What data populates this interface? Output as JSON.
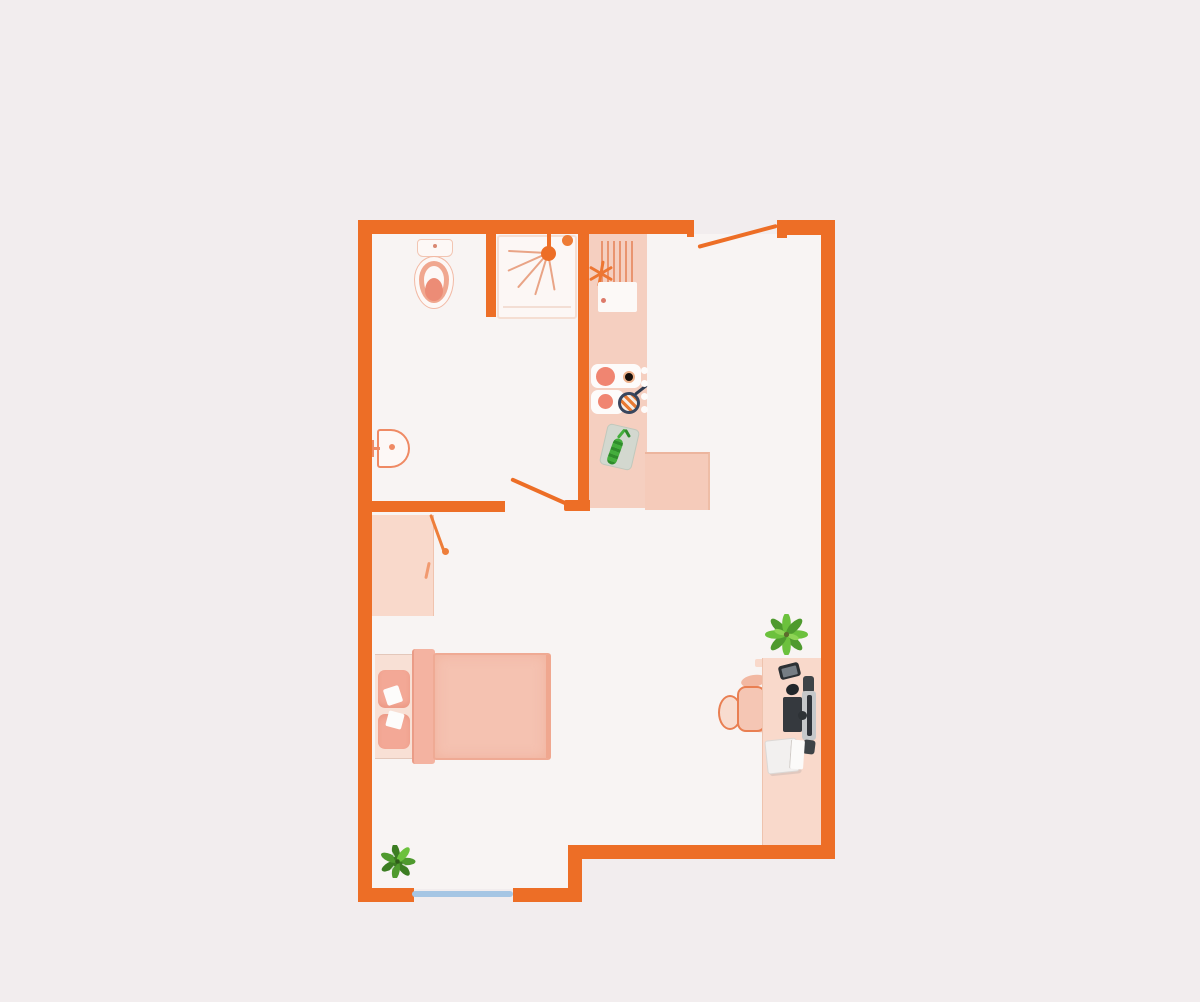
{
  "scene": {
    "type": "floor-plan",
    "style": "top-down studio apartment illustration, no text labels",
    "rooms": [
      {
        "name": "bathroom",
        "position": "top-left",
        "fixtures": [
          "toilet",
          "shower",
          "wash-basin"
        ]
      },
      {
        "name": "kitchen",
        "position": "top-center",
        "fixtures": [
          "kitchen-counter",
          "drying-rack",
          "kitchen-sink",
          "stove-burners",
          "control-knob",
          "frying-pan",
          "cutting-board",
          "cucumber"
        ]
      },
      {
        "name": "main-room",
        "position": "bottom",
        "furniture": [
          "wardrobe",
          "double-bed",
          "pillow",
          "pillow",
          "desk",
          "office-chair",
          "laptop",
          "mouse",
          "keyboard",
          "monitor",
          "speaker",
          "speaker",
          "printer",
          "potted-plant-desk",
          "potted-plant-floor"
        ]
      }
    ],
    "openings": [
      {
        "name": "entry-door",
        "wall": "top-right",
        "state": "open"
      },
      {
        "name": "bathroom-door",
        "wall": "interior",
        "state": "open"
      },
      {
        "name": "window",
        "wall": "bottom-left",
        "state": "closed"
      }
    ]
  },
  "colors": {
    "background": "#f2edee",
    "floor": "#f8f4f3",
    "wall": "#ed6e26",
    "wall-light": "#f0813d",
    "window": "#a6c6e4",
    "counter": "#f5cfc0",
    "counter-l": "#f5cbba",
    "fixture-outline": "#ef8a64",
    "fixture-fill": "#fdf8f6",
    "burner": "#f08571",
    "pan-rim": "#39465e",
    "spray": "#e9a486",
    "bed-blanket": "#f5c2b1",
    "bed-edge": "#efaa94",
    "pillow": "#f3a896",
    "bed-base": "#f8e0d5",
    "wardrobe": "#f9d9cb",
    "desk": "#f9d9cb",
    "chair-fill": "#f5c6b4",
    "chair-outline": "#e97f52",
    "device-dark": "#34383d",
    "device-grey": "#c6c8ca",
    "printer-white": "#f2f0ef",
    "plant-green": "#6cc13d",
    "plant-green-dark": "#4f9a2e",
    "plant-green-light": "#8ed455",
    "plant-green-deep": "#3c7d22",
    "cutting-board": "#d3d8cf",
    "cucumber": "#3da33c"
  }
}
